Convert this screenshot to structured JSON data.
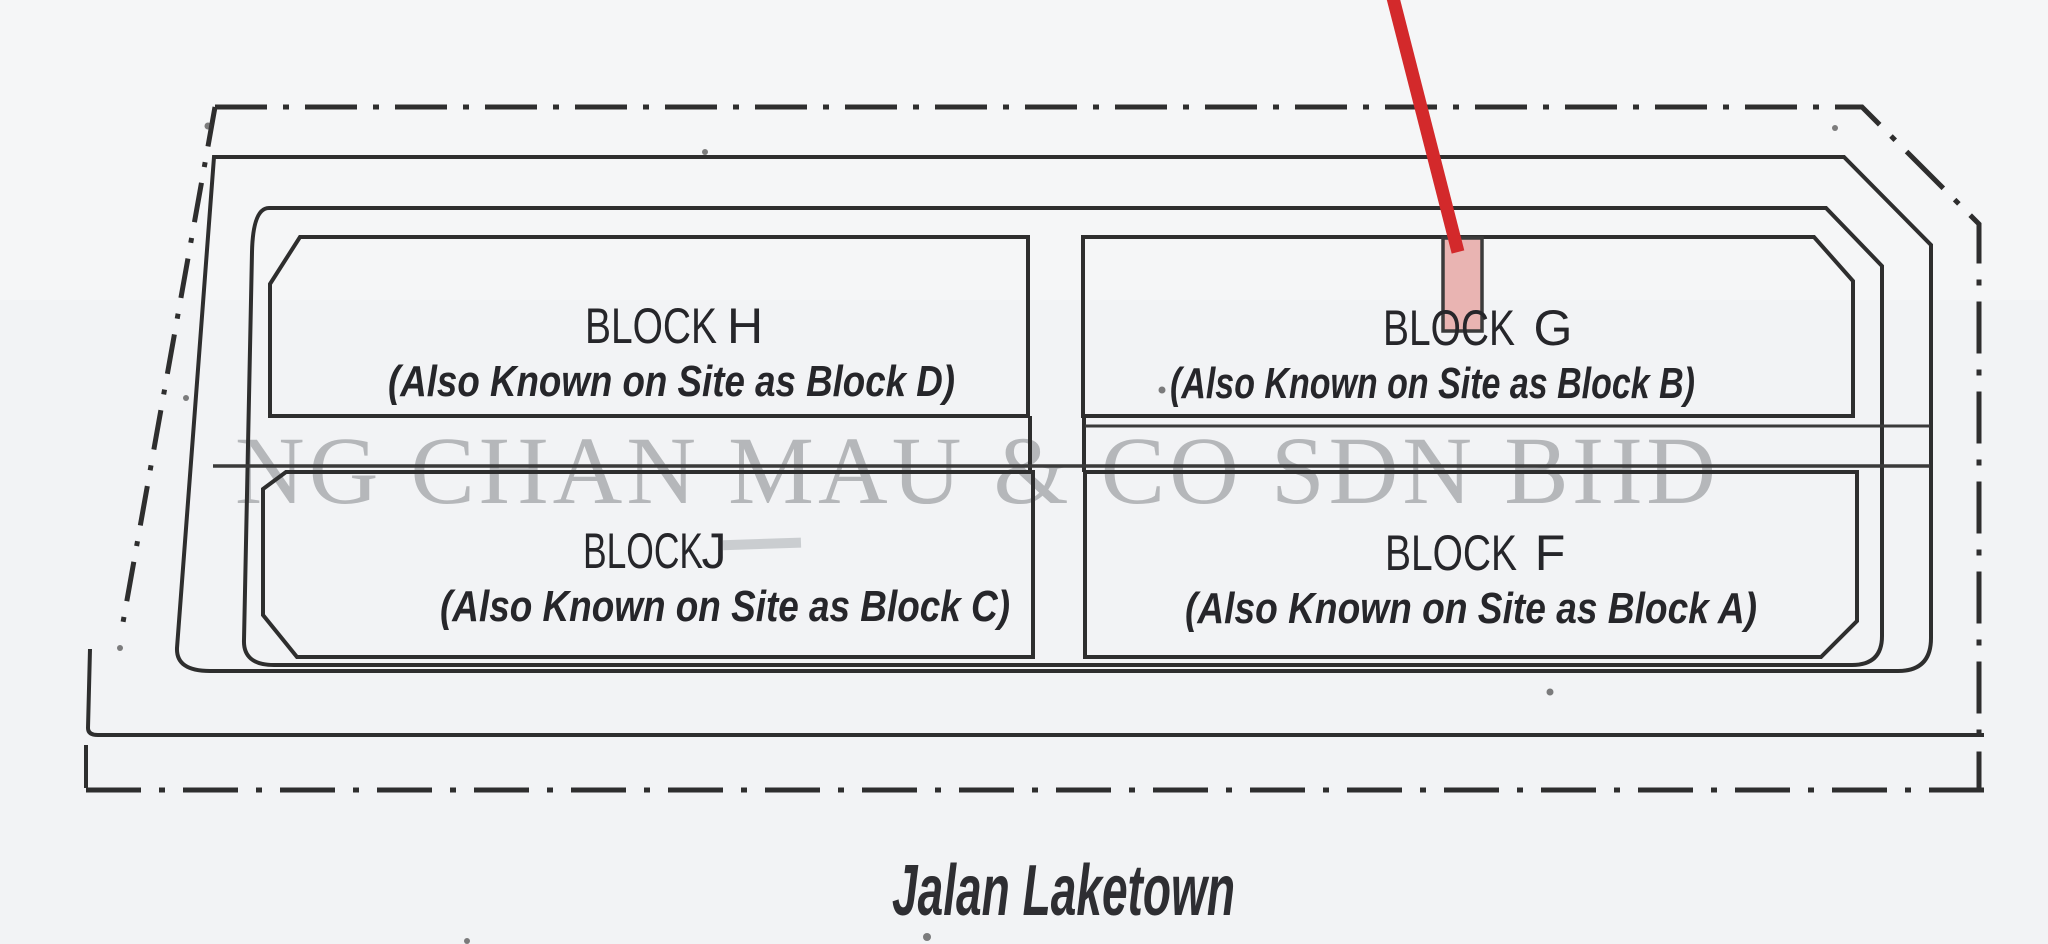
{
  "plan": {
    "watermark": "NG CHAN MAU & CO SDN BHD",
    "road_label": "Jalan Laketown",
    "blocks": [
      {
        "name": "BLOCK",
        "letter": "H",
        "alias": "(Also Known on Site as Block D)"
      },
      {
        "name": "BLOCK",
        "letter": "G",
        "alias": "(Also Known on Site as Block B)"
      },
      {
        "name": "BLOCK",
        "letter": "J",
        "alias": "(Also Known on Site as Block C)"
      },
      {
        "name": "BLOCK",
        "letter": "F",
        "alias": "(Also Known on Site as Block A)"
      }
    ],
    "colors": {
      "marker_red": "#d3292b",
      "marker_pink": "#e9b4b2",
      "ink": "#2e2e2e",
      "watermark_gray": "#7e8285",
      "paper": "#f2f3f5"
    }
  }
}
